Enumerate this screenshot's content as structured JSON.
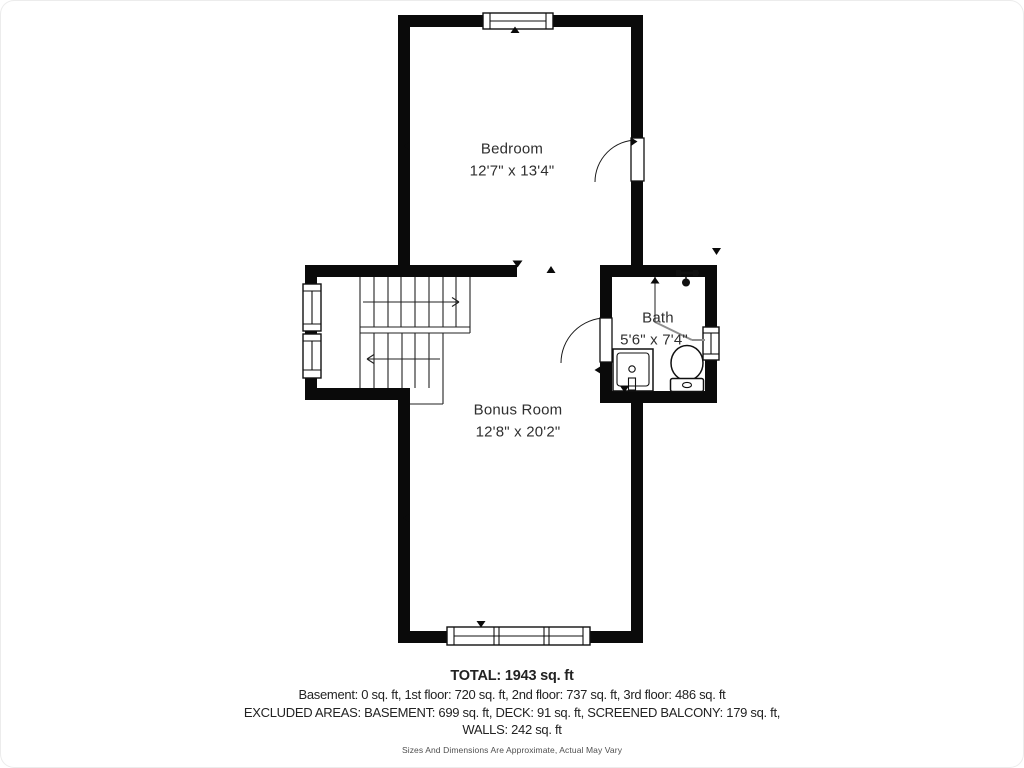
{
  "plan_title": "3rd floor plan",
  "rooms": {
    "bedroom": {
      "name": "Bedroom",
      "dims": "12'7\" x 13'4\""
    },
    "bath": {
      "name": "Bath",
      "dims": "5'6\" x 7'4\""
    },
    "bonus": {
      "name": "Bonus Room",
      "dims": "12'8\" x 20'2\""
    }
  },
  "footer": {
    "total": "TOTAL: 1943 sq. ft",
    "floors": "Basement: 0 sq. ft, 1st floor: 720 sq. ft, 2nd floor: 737 sq. ft, 3rd floor: 486 sq. ft",
    "excluded": "EXCLUDED AREAS: BASEMENT: 699 sq. ft, DECK: 91 sq. ft, SCREENED BALCONY: 179 sq. ft,",
    "walls": "WALLS: 242 sq. ft",
    "disclaimer": "Sizes And Dimensions Are Approximate, Actual May Vary"
  },
  "colors": {
    "wall": "#0a0a0a",
    "background": "#ffffff",
    "text": "#2f2f2f",
    "shower_line": "#8f8f8f"
  }
}
